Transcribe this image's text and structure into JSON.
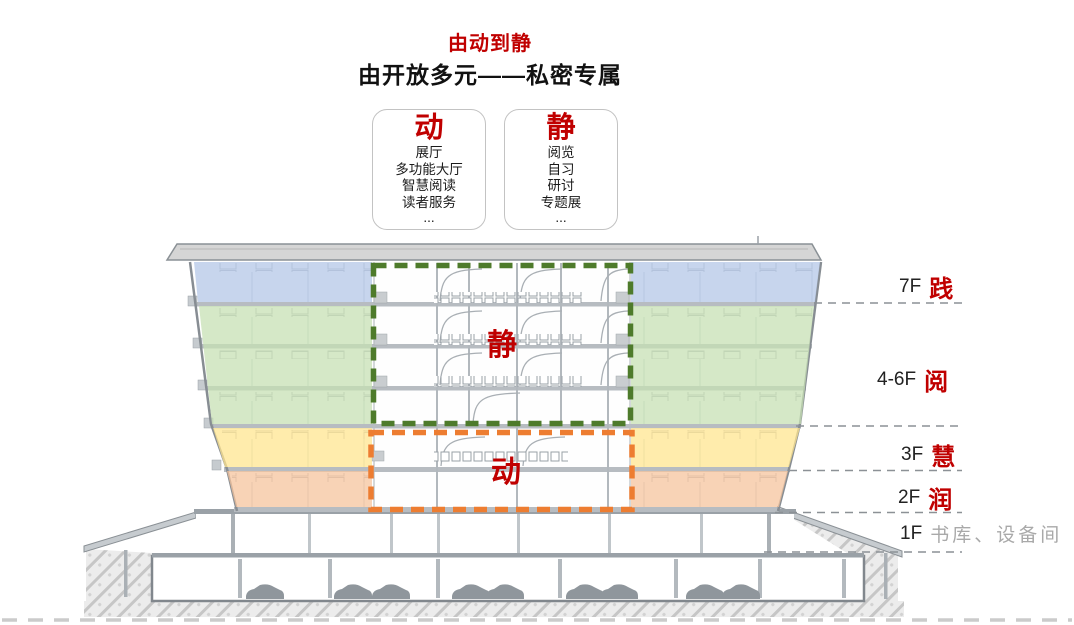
{
  "header": {
    "title": "由动到静",
    "subtitle": "由开放多元——私密专属"
  },
  "legend_boxes": [
    {
      "title": "动",
      "items": [
        "展厅",
        "多功能大厅",
        "智慧阅读",
        "读者服务",
        "..."
      ]
    },
    {
      "title": "静",
      "items": [
        "阅览",
        "自习",
        "研讨",
        "专题展",
        "..."
      ]
    }
  ],
  "section_labels": {
    "jing": "静",
    "dong": "动"
  },
  "floor_labels": [
    {
      "floor": "7F",
      "name": "践"
    },
    {
      "floor": "4-6F",
      "name": "阅"
    },
    {
      "floor": "3F",
      "name": "慧"
    },
    {
      "floor": "2F",
      "name": "润"
    },
    {
      "floor": "1F",
      "name": "书库、设备间"
    }
  ],
  "colors": {
    "accent_red": "#c00000",
    "zone_blue": "#b4c7e7",
    "zone_green": "#c6e0b4",
    "zone_yellow": "#ffe58f",
    "zone_orange": "#f5c39c",
    "dashed_green": "#4e7b2b",
    "dashed_orange": "#ed7d31",
    "muted_gray": "#a9a9a9"
  }
}
